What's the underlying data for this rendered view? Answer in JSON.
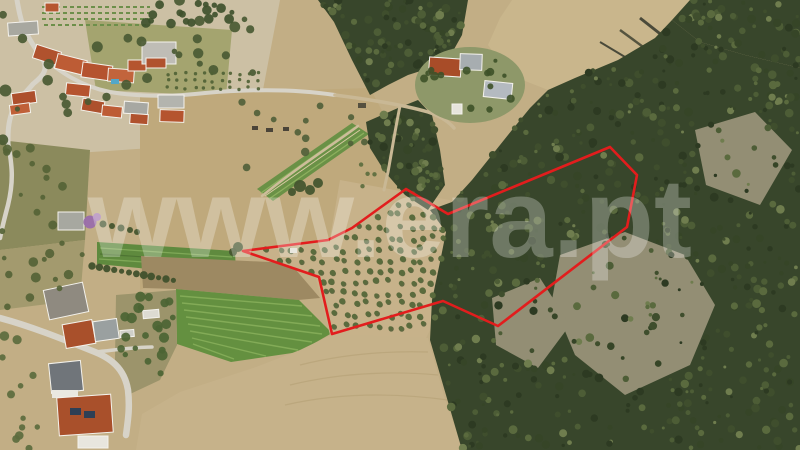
{
  "scene": {
    "description": "Aerial drone photograph of a rural hillside property: village at top-left, olive grove and eucalyptus forest parcel outlined in red, farmland below",
    "watermark": "www.era.pt",
    "watermark_opacity": 0.27,
    "boundary": {
      "color": "#e21d1d",
      "stroke_width": 2.6,
      "points": "406,189 448,214 610,147 637,175 627,227 498,326 443,301 332,334 319,277 243,251 328,240 352,228"
    },
    "palette": {
      "soil_tan": "#c2ae85",
      "slope_tan": "#bfa97c",
      "forest_green": "#38462b",
      "rock_gray": "#a39b81",
      "field_green": "#649040",
      "olive_tree_green": "#5a6b3d",
      "roof_red": "#b0522e",
      "road_gray": "#d7d3c8",
      "watermark_white": "#ffffff"
    }
  }
}
